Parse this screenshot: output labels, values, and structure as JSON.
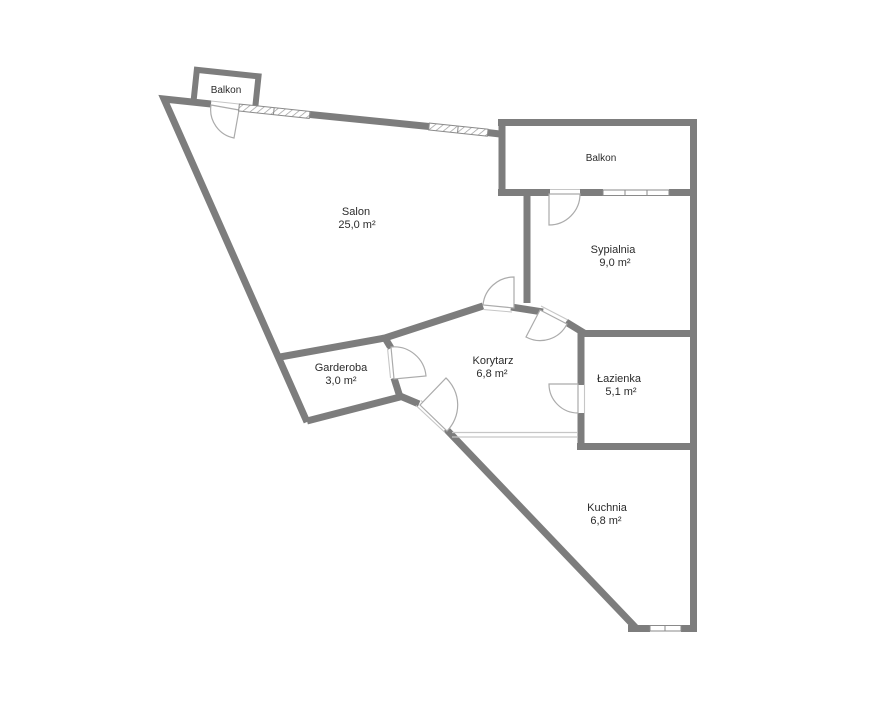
{
  "floorplan": {
    "balcony_left": {
      "label": "Balkon"
    },
    "balcony_right": {
      "label": "Balkon"
    },
    "rooms": [
      {
        "id": "salon",
        "label": "Salon",
        "area": "25,0 m²"
      },
      {
        "id": "sypialnia",
        "label": "Sypialnia",
        "area": "9,0 m²"
      },
      {
        "id": "garderoba",
        "label": "Garderoba",
        "area": "3,0 m²"
      },
      {
        "id": "korytarz",
        "label": "Korytarz",
        "area": "6,8 m²"
      },
      {
        "id": "lazienka",
        "label": "Łazienka",
        "area": "5,1 m²"
      },
      {
        "id": "kuchnia",
        "label": "Kuchnia",
        "area": "6,8 m²"
      }
    ],
    "colors": {
      "wall": "#7d7d7d",
      "door_arc": "#ababab",
      "window_frame": "#8a8a8a",
      "opening_line": "#c6c6c6",
      "text": "#2b2b2b",
      "background": "#ffffff"
    }
  }
}
